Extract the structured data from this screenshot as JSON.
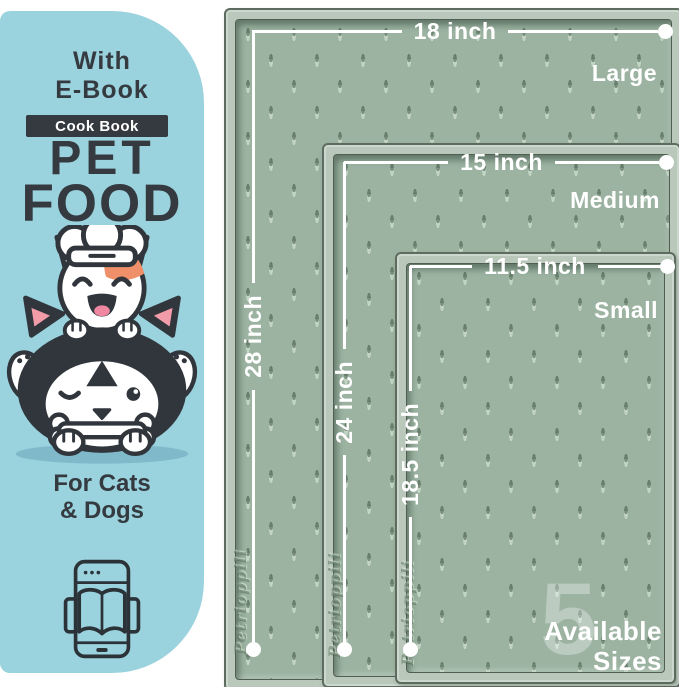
{
  "panel": {
    "header_line1": "With",
    "header_line2": "E-Book",
    "badge_label": "Cook Book",
    "title_line1": "PET",
    "title_line2": "FOOD",
    "footer_line1": "For Cats",
    "footer_line2": "& Dogs",
    "bg_color": "#9AD3DE",
    "ink_color": "#343A40"
  },
  "mats": {
    "surface_color": "#9CB3A2",
    "rim_color": "#B9C8BA",
    "line_color": "#FFFFFF",
    "embossed_brand": "Petrioppili",
    "sizes": [
      {
        "name": "Large",
        "width": "18 inch",
        "height": "28 inch"
      },
      {
        "name": "Medium",
        "width": "15 inch",
        "height": "24 inch"
      },
      {
        "name": "Small",
        "width": "11.5 inch",
        "height": "18.5 inch"
      }
    ],
    "availability": {
      "count": "5",
      "line1": "Available",
      "line2": "Sizes"
    }
  }
}
